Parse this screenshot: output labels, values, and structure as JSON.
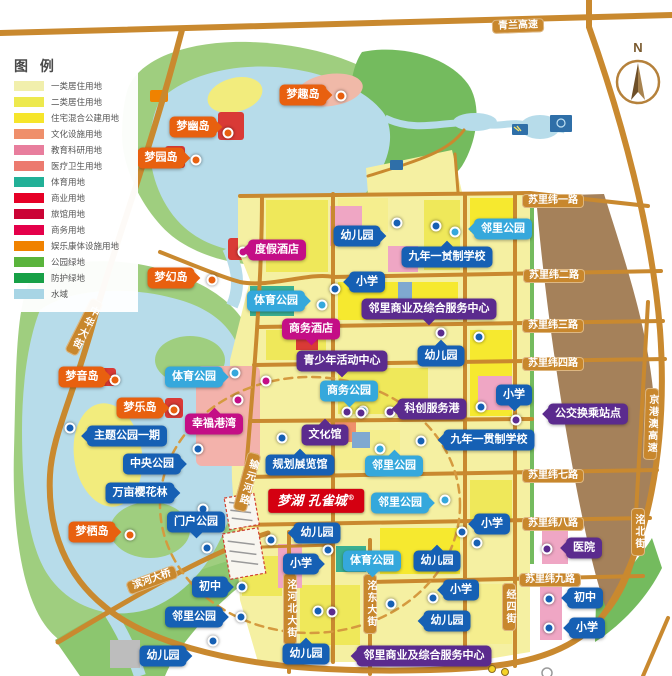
{
  "palette": {
    "blue": "#1660B4",
    "cyan": "#35A8DC",
    "purple": "#5B2B8E",
    "magenta": "#C40E86",
    "orange": "#E8600F",
    "street": "#C8872D",
    "logo_red": "#D40011"
  },
  "legend": {
    "title": "图 例",
    "items": [
      {
        "label": "一类居住用地",
        "color": "#F1EFAC"
      },
      {
        "label": "二类居住用地",
        "color": "#EDE94E"
      },
      {
        "label": "住宅混合公建用地",
        "color": "#F6E52B"
      },
      {
        "label": "文化设施用地",
        "color": "#EF8F6B"
      },
      {
        "label": "教育科研用地",
        "color": "#E87E9D"
      },
      {
        "label": "医疗卫生用地",
        "color": "#EC7A6F"
      },
      {
        "label": "体育用地",
        "color": "#22B097"
      },
      {
        "label": "商业用地",
        "color": "#E60026"
      },
      {
        "label": "旅馆用地",
        "color": "#CB0335"
      },
      {
        "label": "商务用地",
        "color": "#E4004A"
      },
      {
        "label": "娱乐康体设施用地",
        "color": "#F08200"
      },
      {
        "label": "公园绿地",
        "color": "#5AB43C"
      },
      {
        "label": "防护绿地",
        "color": "#17A046"
      },
      {
        "label": "水域",
        "color": "#A8D5E5"
      }
    ]
  },
  "compass": {
    "label": "N"
  },
  "streets": [
    {
      "t": "青兰高速",
      "x": 518,
      "y": 26,
      "rot": -2
    },
    {
      "t": "苏里纬一路",
      "x": 553,
      "y": 201
    },
    {
      "t": "苏里纬二路",
      "x": 554,
      "y": 276
    },
    {
      "t": "苏里纬三路",
      "x": 553,
      "y": 326
    },
    {
      "t": "苏里纬四路",
      "x": 553,
      "y": 364
    },
    {
      "t": "苏里纬七路",
      "x": 553,
      "y": 476
    },
    {
      "t": "苏里纬八路",
      "x": 553,
      "y": 524
    },
    {
      "t": "苏里纬九路",
      "x": 550,
      "y": 580
    },
    {
      "t": "滨河大桥",
      "x": 152,
      "y": 580,
      "rot": -20
    },
    {
      "t": "中华大街",
      "x": 84,
      "y": 327,
      "vert": true,
      "rot": 27
    },
    {
      "t": "输元河路",
      "x": 247,
      "y": 482,
      "vert": true,
      "rot": 15
    },
    {
      "t": "京港澳高速",
      "x": 651,
      "y": 424,
      "vert": true,
      "rot": 2
    },
    {
      "t": "洺河北大街",
      "x": 290,
      "y": 609,
      "vert": true
    },
    {
      "t": "洺东大街",
      "x": 370,
      "y": 604,
      "vert": true
    },
    {
      "t": "洺北街",
      "x": 638,
      "y": 532,
      "vert": true
    },
    {
      "t": "经四街",
      "x": 509,
      "y": 607,
      "vert": true
    }
  ],
  "markers": [
    {
      "t": "梦趣岛",
      "c": "orange",
      "x": 303,
      "y": 95,
      "tail": "r",
      "dot": [
        341,
        96
      ]
    },
    {
      "t": "梦幽岛",
      "c": "orange",
      "x": 193,
      "y": 127,
      "tail": "r",
      "dot": [
        228,
        133
      ]
    },
    {
      "t": "梦园岛",
      "c": "orange",
      "x": 161,
      "y": 158,
      "tail": "r",
      "dot": [
        196,
        160
      ]
    },
    {
      "t": "梦幻岛",
      "c": "orange",
      "x": 171,
      "y": 278,
      "tail": "r",
      "dot": [
        212,
        280
      ]
    },
    {
      "t": "梦音岛",
      "c": "orange",
      "x": 82,
      "y": 377,
      "tail": "r",
      "dot": [
        115,
        380
      ]
    },
    {
      "t": "梦乐岛",
      "c": "orange",
      "x": 140,
      "y": 408,
      "tail": "r",
      "dot": [
        174,
        410
      ]
    },
    {
      "t": "梦栖岛",
      "c": "orange",
      "x": 92,
      "y": 532,
      "tail": "r",
      "dot": [
        130,
        535
      ]
    },
    {
      "t": "度假酒店",
      "c": "magenta",
      "x": 277,
      "y": 250,
      "tail": "l",
      "dot": [
        243,
        252
      ]
    },
    {
      "t": "商务酒店",
      "c": "magenta",
      "x": 311,
      "y": 329,
      "tail": "b",
      "dot": [
        266,
        381
      ]
    },
    {
      "t": "幸福港湾",
      "c": "magenta",
      "x": 214,
      "y": 424,
      "tail": "t",
      "dot": [
        238,
        400
      ]
    },
    {
      "t": "邻里公园",
      "c": "cyan",
      "x": 503,
      "y": 229,
      "tail": "l",
      "dot": [
        455,
        232
      ]
    },
    {
      "t": "体育公园",
      "c": "cyan",
      "x": 276,
      "y": 301,
      "tail": "r",
      "dot": [
        322,
        305
      ]
    },
    {
      "t": "体育公园",
      "c": "cyan",
      "x": 194,
      "y": 377,
      "tail": "r",
      "dot": [
        235,
        373
      ]
    },
    {
      "t": "商务公园",
      "c": "cyan",
      "x": 349,
      "y": 391,
      "tail": "b",
      "dot": [
        363,
        411
      ]
    },
    {
      "t": "邻里公园",
      "c": "cyan",
      "x": 394,
      "y": 466,
      "tail": "t",
      "dot": [
        380,
        449
      ]
    },
    {
      "t": "体育公园",
      "c": "cyan",
      "x": 372,
      "y": 561,
      "tail": "b"
    },
    {
      "t": "邻里公园",
      "c": "cyan",
      "x": 400,
      "y": 503,
      "tail": "r",
      "dot": [
        445,
        500
      ]
    },
    {
      "t": "幼儿园",
      "c": "blue",
      "x": 357,
      "y": 236,
      "tail": "r",
      "dot": [
        397,
        223
      ]
    },
    {
      "t": "九年一贯制学校",
      "c": "blue",
      "x": 447,
      "y": 257,
      "tail": "t",
      "dot": [
        436,
        226
      ]
    },
    {
      "t": "小学",
      "c": "blue",
      "x": 367,
      "y": 282,
      "tail": "l",
      "dot": [
        335,
        289
      ]
    },
    {
      "t": "小学",
      "c": "blue",
      "x": 514,
      "y": 395,
      "tail": "b",
      "dot": [
        481,
        407
      ]
    },
    {
      "t": "幼儿园",
      "c": "blue",
      "x": 441,
      "y": 356,
      "tail": "t",
      "dot": [
        479,
        337
      ]
    },
    {
      "t": "九年一贯制学校",
      "c": "blue",
      "x": 489,
      "y": 440,
      "tail": "l",
      "dot": [
        421,
        441
      ]
    },
    {
      "t": "主题公园一期",
      "c": "blue",
      "x": 127,
      "y": 436,
      "tail": "l",
      "dot": [
        70,
        428
      ]
    },
    {
      "t": "中央公园",
      "c": "blue",
      "x": 152,
      "y": 464,
      "tail": "r",
      "dot": [
        198,
        449
      ]
    },
    {
      "t": "规划展览馆",
      "c": "blue",
      "x": 300,
      "y": 465,
      "tail": "t",
      "dot": [
        282,
        438
      ]
    },
    {
      "t": "万亩樱花林",
      "c": "blue",
      "x": 140,
      "y": 493,
      "tail": "r",
      "dot": [
        203,
        509
      ]
    },
    {
      "t": "门户公园",
      "c": "blue",
      "x": 196,
      "y": 522,
      "tail": "b",
      "dot": [
        207,
        548
      ]
    },
    {
      "t": "幼儿园",
      "c": "blue",
      "x": 317,
      "y": 533,
      "tail": "l",
      "dot": [
        271,
        540
      ]
    },
    {
      "t": "小学",
      "c": "blue",
      "x": 492,
      "y": 524,
      "tail": "l",
      "dot": [
        462,
        532
      ]
    },
    {
      "t": "小学",
      "c": "blue",
      "x": 301,
      "y": 564,
      "tail": "r",
      "dot": [
        328,
        550
      ]
    },
    {
      "t": "幼儿园",
      "c": "blue",
      "x": 437,
      "y": 561,
      "tail": "t",
      "dot": [
        477,
        543
      ]
    },
    {
      "t": "初中",
      "c": "blue",
      "x": 210,
      "y": 587,
      "tail": "r",
      "dot": [
        242,
        587
      ]
    },
    {
      "t": "小学",
      "c": "blue",
      "x": 461,
      "y": 590,
      "tail": "l",
      "dot": [
        433,
        598
      ]
    },
    {
      "t": "邻里公园",
      "c": "blue",
      "x": 194,
      "y": 617,
      "tail": "r",
      "dot": [
        241,
        617
      ]
    },
    {
      "t": "幼儿园",
      "c": "blue",
      "x": 447,
      "y": 621,
      "tail": "l",
      "dot": [
        391,
        604
      ]
    },
    {
      "t": "初中",
      "c": "blue",
      "x": 585,
      "y": 598,
      "tail": "l",
      "dot": [
        549,
        599
      ]
    },
    {
      "t": "小学",
      "c": "blue",
      "x": 587,
      "y": 628,
      "tail": "l",
      "dot": [
        549,
        628
      ]
    },
    {
      "t": "幼儿园",
      "c": "blue",
      "x": 163,
      "y": 656,
      "tail": "r",
      "dot": [
        213,
        641
      ]
    },
    {
      "t": "幼儿园",
      "c": "blue",
      "x": 306,
      "y": 654,
      "tail": "t",
      "dot": [
        318,
        611
      ]
    },
    {
      "t": "邻里商业及综合服务中心",
      "c": "purple",
      "x": 429,
      "y": 309,
      "tail": "b",
      "dot": [
        441,
        333
      ]
    },
    {
      "t": "青少年活动中心",
      "c": "purple",
      "x": 342,
      "y": 361,
      "tail": "b",
      "dot": [
        347,
        412
      ]
    },
    {
      "t": "科创服务港",
      "c": "purple",
      "x": 432,
      "y": 409,
      "tail": "l",
      "dot": [
        390,
        412
      ]
    },
    {
      "t": "公交换乘站点",
      "c": "purple",
      "x": 588,
      "y": 414,
      "tail": "l",
      "dot": [
        516,
        420
      ]
    },
    {
      "t": "文化馆",
      "c": "purple",
      "x": 325,
      "y": 435,
      "tail": "t",
      "dot": [
        361,
        413
      ]
    },
    {
      "t": "医院",
      "c": "purple",
      "x": 584,
      "y": 548,
      "tail": "l",
      "dot": [
        547,
        549
      ]
    },
    {
      "t": "邻里商业及综合服务中心",
      "c": "purple",
      "x": 424,
      "y": 656,
      "tail": "l",
      "dot": [
        332,
        612
      ]
    }
  ],
  "logo": {
    "text": "梦湖 孔雀城",
    "mark": "®"
  }
}
